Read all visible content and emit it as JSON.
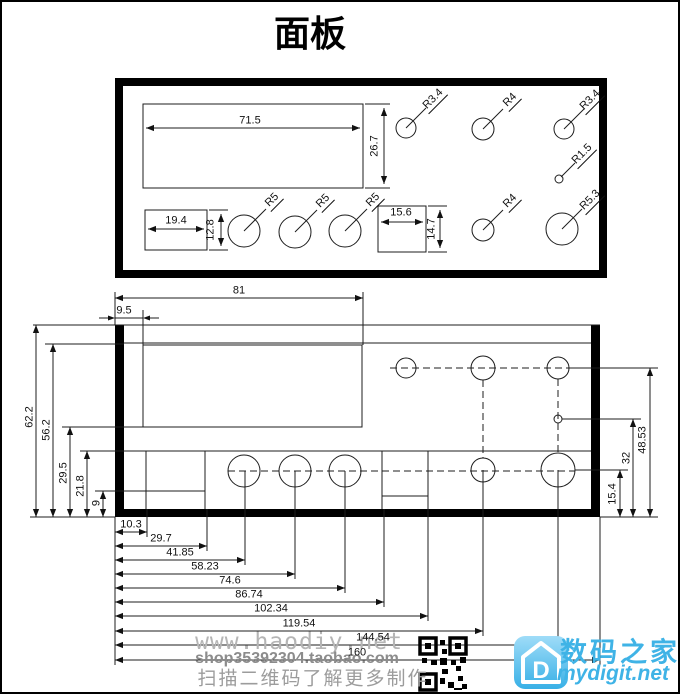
{
  "title": "面板",
  "top_view": {
    "dim_width": "71.5",
    "dim_height": "26.7",
    "left_cutout": {
      "w": "19.4",
      "h": "12.8"
    },
    "mid_cutout": {
      "w": "15.6",
      "h": "14.7"
    },
    "radius_labels": [
      "R5",
      "R5",
      "R5",
      "R3.4",
      "R4",
      "R3.4",
      "R1.5",
      "R4",
      "R5.3"
    ]
  },
  "bottom_view": {
    "dim_81": "81",
    "dim_9_5": "9.5",
    "left_dims": [
      "62.2",
      "56.2",
      "29.5",
      "21.8",
      "9"
    ],
    "right_dims": [
      "48.53",
      "32",
      "15.4"
    ],
    "bottom_dims": [
      "10.3",
      "29.7",
      "41.85",
      "58.23",
      "74.6",
      "86.74",
      "102.34",
      "119.54",
      "144.54",
      "160"
    ]
  },
  "footer": {
    "watermark_url": "www.haodiy.net",
    "watermark_shop": "shop35392304.taobao.com",
    "watermark_note": "扫描二维码了解更多制作",
    "brand_cn": "数码之家",
    "brand_en": "mydigit.net",
    "logo_letter": "D",
    "brand_color": "#3fb3e6"
  }
}
